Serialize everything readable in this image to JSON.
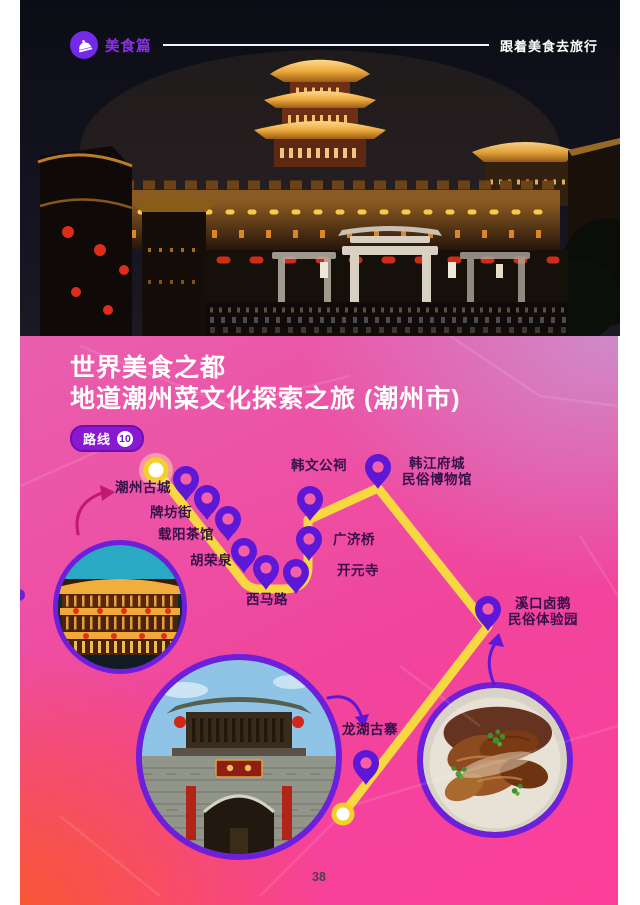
{
  "header": {
    "logo": "美食篇",
    "tagline": "跟着美食去旅行"
  },
  "section": {
    "title_line1": "世界美食之都",
    "title_line2": "地道潮州菜文化探索之旅 (潮州市)",
    "route_label": "路线",
    "route_number": "10"
  },
  "map": {
    "labels": [
      {
        "id": "chaozhou-ancient-city",
        "text": "潮州古城"
      },
      {
        "id": "paifang-street",
        "text": "牌坊街"
      },
      {
        "id": "zaiyang-teahouse",
        "text": "载阳茶馆"
      },
      {
        "id": "hurongquan",
        "text": "胡荣泉"
      },
      {
        "id": "xima-road",
        "text": "西马路"
      },
      {
        "id": "kaiyuan-temple",
        "text": "开元寺"
      },
      {
        "id": "guangji-bridge",
        "text": "广济桥"
      },
      {
        "id": "hanwengong-shrine",
        "text": "韩文公祠"
      },
      {
        "id": "hanjiang-fucheng-museum",
        "text": "韩江府城\n民俗博物馆"
      },
      {
        "id": "xikou-braised-goose-park",
        "text": "溪口卤鹅\n民俗体验园"
      },
      {
        "id": "longhu-ancient-village",
        "text": "龙湖古寨"
      }
    ]
  },
  "footer": {
    "page_number": "38"
  },
  "colors": {
    "pin_purple": "#5d17d6",
    "ring_purple": "#6d1fdc",
    "route_yellow": "#f8d840",
    "panel_pink": "#f0459d",
    "badge_purple": "#8a18d2",
    "label_dark": "#36104a",
    "logo_purple": "#7428e8"
  }
}
